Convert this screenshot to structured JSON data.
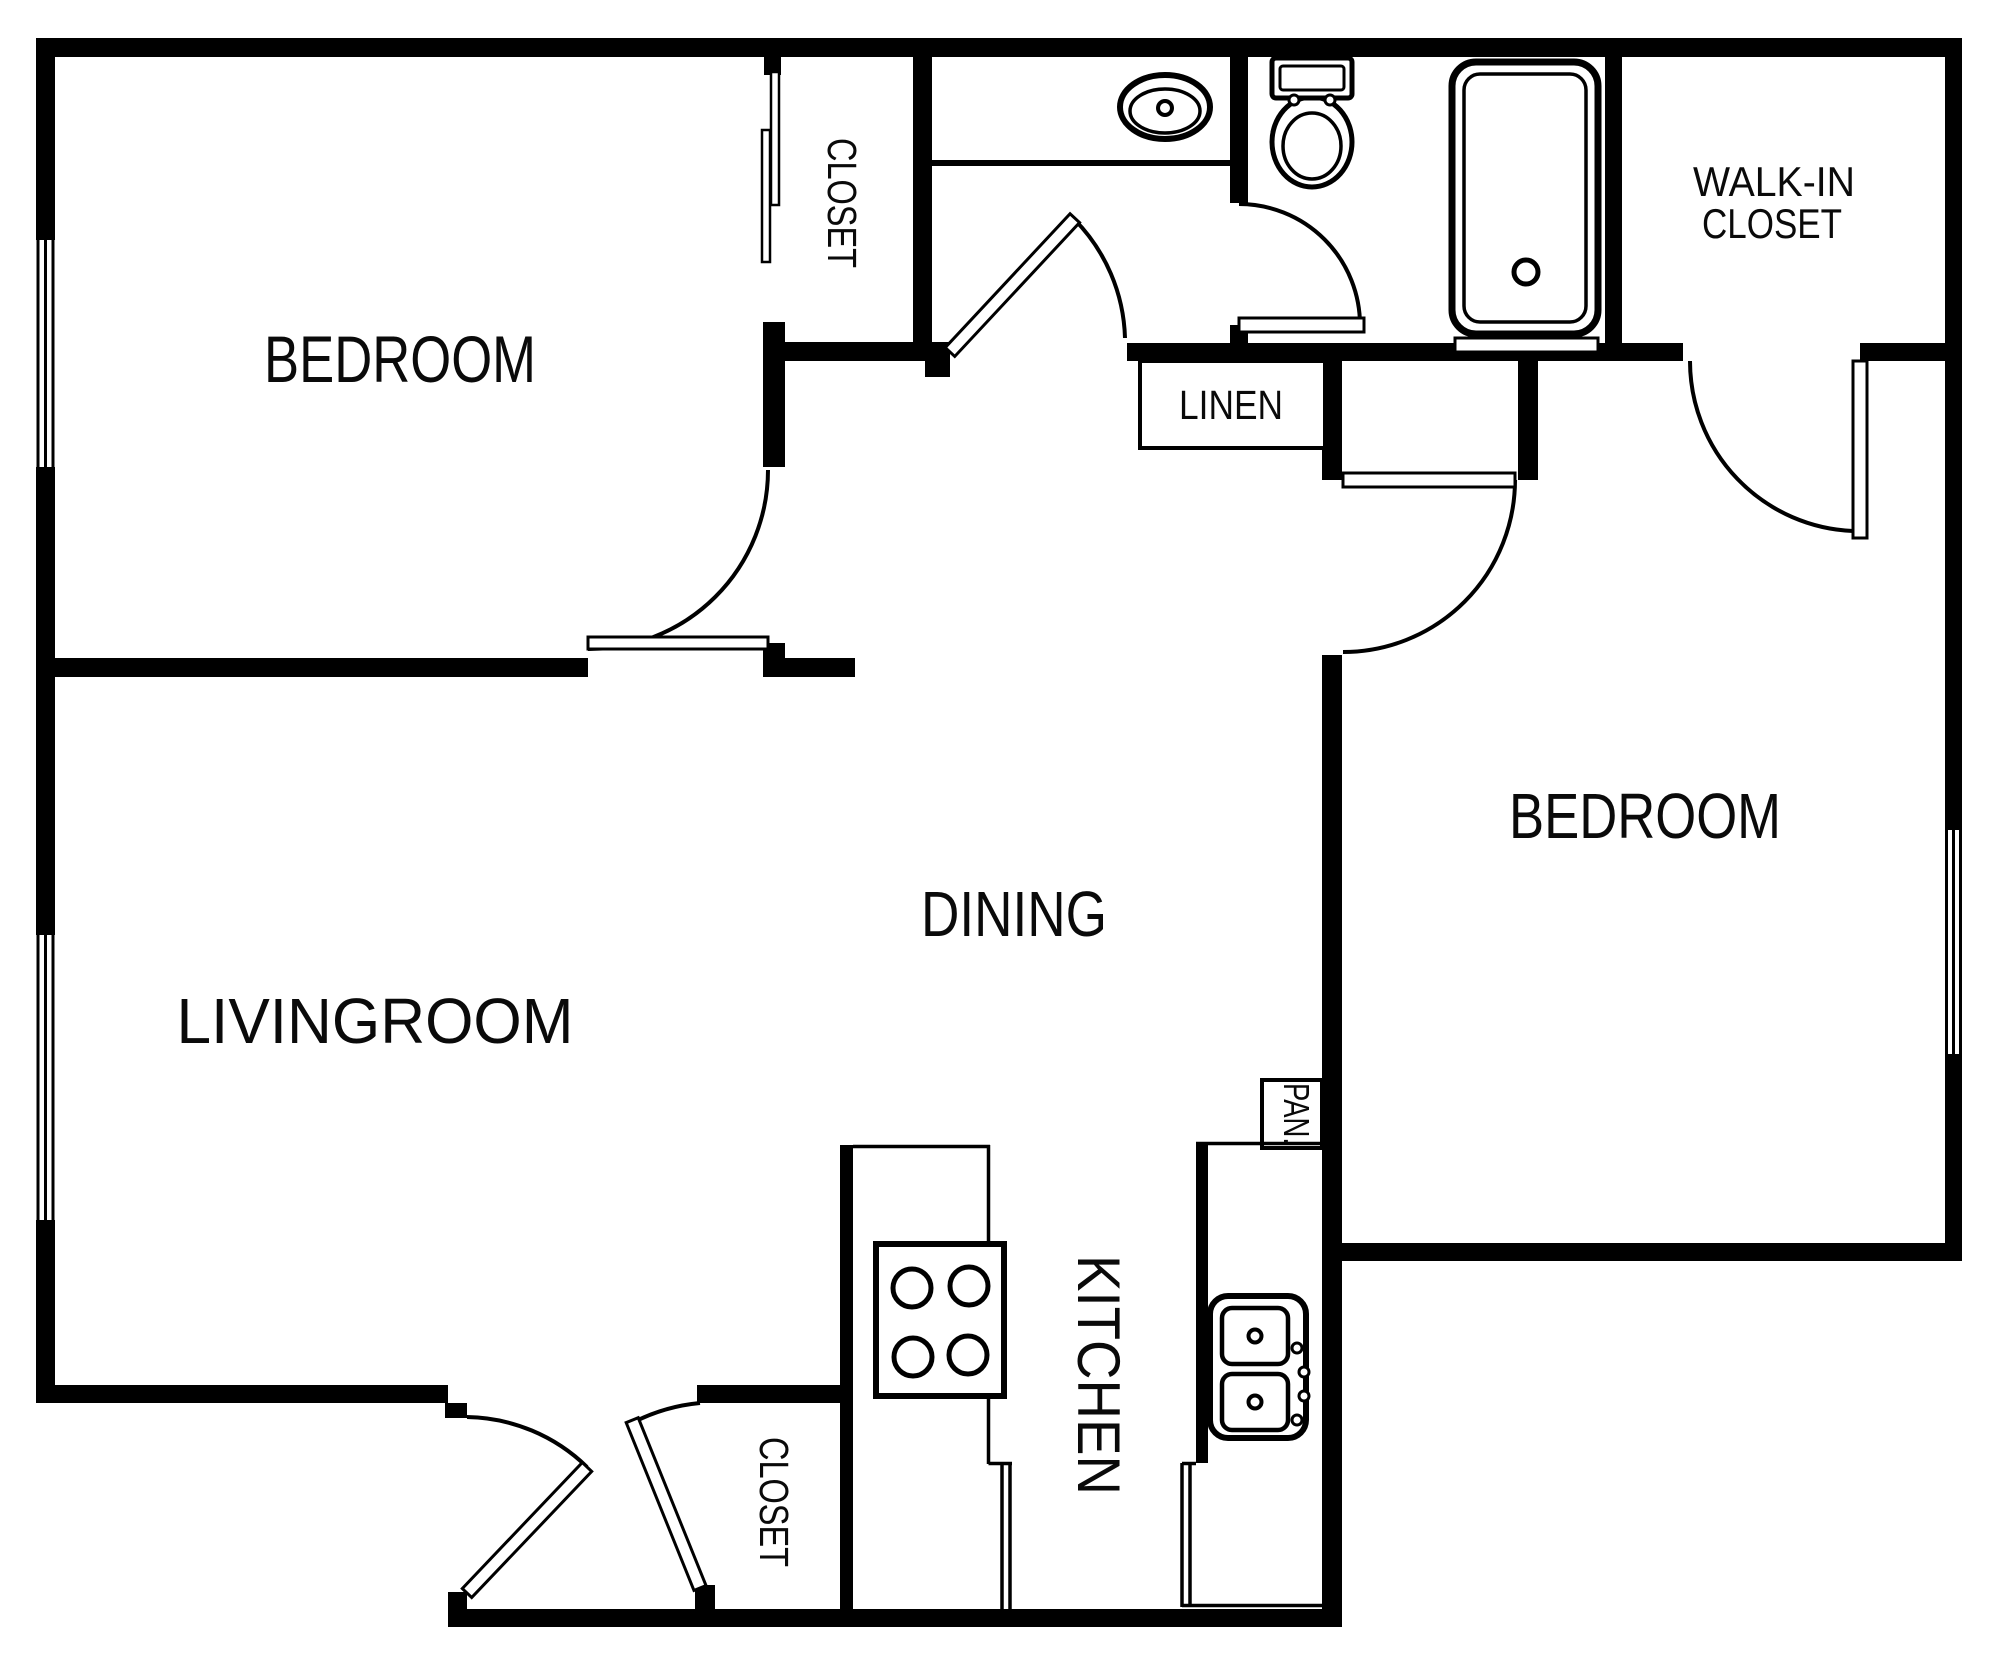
{
  "floorplan": {
    "background": "#ffffff",
    "line_color": "#000000",
    "labels": {
      "bedroom_top_left": "BEDROOM",
      "closet_top": "CLOSET",
      "walkin_line1": "WALK-IN",
      "walkin_line2": "CLOSET",
      "linen": "LINEN",
      "bedroom_right": "BEDROOM",
      "dining": "DINING",
      "livingroom": "LIVINGROOM",
      "kitchen": "KITCHEN",
      "pantry": "PAN.",
      "closet_bottom": "CLOSET"
    }
  }
}
